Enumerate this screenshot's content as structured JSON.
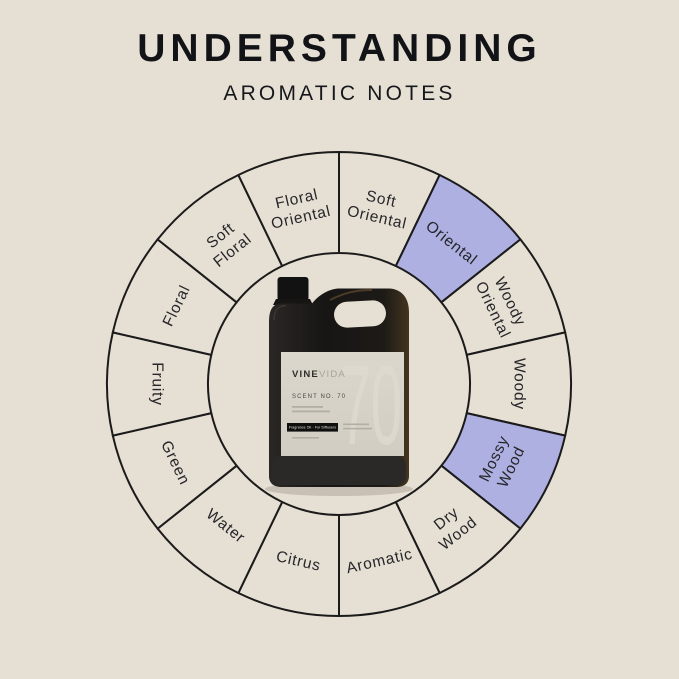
{
  "page": {
    "background": "#e6dfd3"
  },
  "header": {
    "title": "UNDERSTANDING",
    "subtitle": "AROMATIC NOTES"
  },
  "wheel": {
    "stroke_color": "#1b1b1b",
    "segment_fill": "#e6dfd3",
    "highlight_fill": "#aeb0e2",
    "label_color": "#26262a",
    "segments": [
      {
        "label": "Soft Oriental",
        "lines": [
          "Soft",
          "Oriental"
        ],
        "highlighted": false
      },
      {
        "label": "Oriental",
        "lines": [
          "Oriental"
        ],
        "highlighted": true
      },
      {
        "label": "Woody Oriental",
        "lines": [
          "Woody",
          "Oriental"
        ],
        "highlighted": false
      },
      {
        "label": "Woody",
        "lines": [
          "Woody"
        ],
        "highlighted": false
      },
      {
        "label": "Mossy Wood",
        "lines": [
          "Mossy",
          "Wood"
        ],
        "highlighted": true
      },
      {
        "label": "Dry Wood",
        "lines": [
          "Dry",
          "Wood"
        ],
        "highlighted": false
      },
      {
        "label": "Aromatic",
        "lines": [
          "Aromatic"
        ],
        "highlighted": false
      },
      {
        "label": "Citrus",
        "lines": [
          "Citrus"
        ],
        "highlighted": false
      },
      {
        "label": "Water",
        "lines": [
          "Water"
        ],
        "highlighted": false
      },
      {
        "label": "Green",
        "lines": [
          "Green"
        ],
        "highlighted": false
      },
      {
        "label": "Fruity",
        "lines": [
          "Fruity"
        ],
        "highlighted": false
      },
      {
        "label": "Floral",
        "lines": [
          "Floral"
        ],
        "highlighted": false
      },
      {
        "label": "Soft Floral",
        "lines": [
          "Soft",
          "Floral"
        ],
        "highlighted": false
      },
      {
        "label": "Floral Oriental",
        "lines": [
          "Floral",
          "Oriental"
        ],
        "highlighted": false
      }
    ]
  },
  "bottle": {
    "brand_bold": "VINE",
    "brand_light": "VIDA",
    "scent_no": "SCENT NO. 70",
    "watermark": "70",
    "bar_text": "Fragrance Oil - For Diffusers"
  }
}
